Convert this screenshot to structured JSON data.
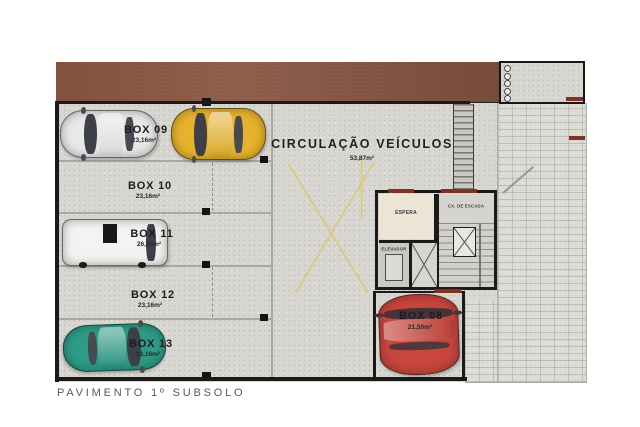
{
  "footer": {
    "title": "PAVIMENTO 1º SUBSOLO"
  },
  "circulation": {
    "label": "CIRCULAÇÃO VEÍCULOS",
    "area": "53,87m²"
  },
  "parking_boxes": [
    {
      "label": "BOX 09",
      "area": "23,16m²"
    },
    {
      "label": "BOX 10",
      "area": "23,16m²"
    },
    {
      "label": "BOX 11",
      "area": "26,55m²"
    },
    {
      "label": "BOX 12",
      "area": "23,16m²"
    },
    {
      "label": "BOX 13",
      "area": "23,16m²"
    },
    {
      "label": "BOX 08",
      "area": "21,50m²"
    }
  ],
  "rooms": {
    "espera": {
      "label": "ESPERA"
    },
    "cx_escada": {
      "label": "CX. DE ESCADA"
    },
    "elevador": {
      "label": "ELEVADOR"
    }
  },
  "colors": {
    "terrain": "#8a5743",
    "wall": "#1a1a1a",
    "accent-red": "#7e3226",
    "guide-yellow": "#d9ca74",
    "espera-floor": "#ece4d4"
  },
  "cars": [
    {
      "name": "car-silver",
      "color": "#e9e9e9"
    },
    {
      "name": "car-yellow",
      "color": "#e7b22c"
    },
    {
      "name": "van-white",
      "color": "#f3f3f1"
    },
    {
      "name": "car-teal",
      "color": "#2d9c87"
    },
    {
      "name": "car-red",
      "color": "#c8463d"
    }
  ]
}
